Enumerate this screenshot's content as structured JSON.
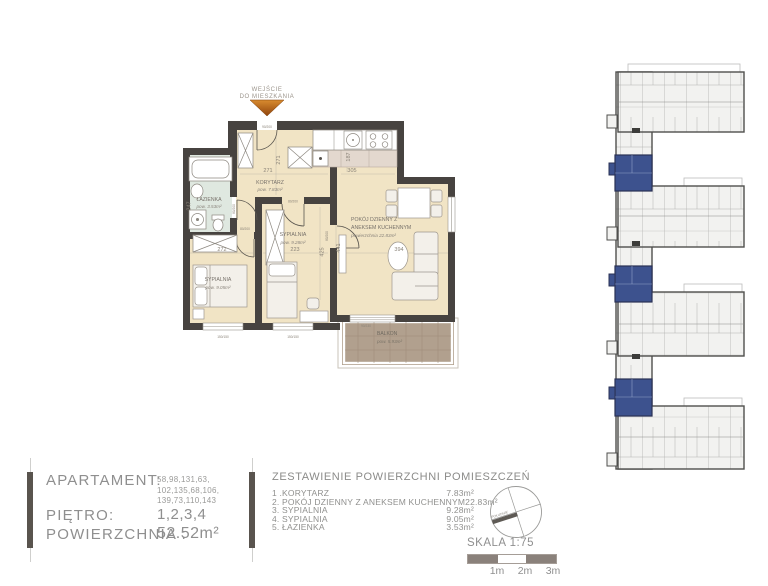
{
  "entrance": {
    "line1": "WEJŚCIE",
    "line2": "DO MIESZKANIA",
    "size_label": "90/200"
  },
  "rooms": {
    "lazienka": {
      "name": "ŁAZIENKA",
      "area": "pow. 3.53m²"
    },
    "korytarz": {
      "name": "KORYTARZ",
      "area": "pow. 7.83m²"
    },
    "sypialnia_3": {
      "name": "SYPIALNIA",
      "area": "pow. 9.28m²"
    },
    "sypialnia_4": {
      "name": "SYPIALNIA",
      "area": "pow. 9.05m²"
    },
    "pokoj": {
      "name_line1": "POKÓJ DZIENNY Z",
      "name_line2": "ANEKSEM KUCHENNYM",
      "area": "powierzchnia 22.83m²"
    },
    "balkon": {
      "name": "BALKON",
      "area": "pow. 5.93m²"
    }
  },
  "dimensions": {
    "korytarz_w": "271",
    "korytarz_h": "271",
    "kuchnia_w": "305",
    "kuchnia_d": "187",
    "lazienka_h": "247",
    "sypialnia4_w": "272",
    "sypialnia3_w": "223",
    "pokoj_w": "394",
    "pokoj_h": "441",
    "sypialnia3_h": "425"
  },
  "openings": {
    "door_bath": "80/200",
    "door_bed4": "80/200",
    "door_bed3": "80/200",
    "door_living": "80/200",
    "window_bed4": "150/150",
    "window_bed3": "150/150",
    "balcony_door": "90/230"
  },
  "info": {
    "apartament_label": "APARTAMENT:",
    "numbers_line1": "58,98,131,63,",
    "numbers_line2": "102,135,68,106,",
    "numbers_line3": "139,73,110,143",
    "pietro_label": "PIĘTRO:",
    "pietro_value": "1,2,3,4",
    "powierzchnia_label": "POWIERZCHNIA :",
    "powierzchnia_value": "52.52m²"
  },
  "room_list": {
    "title": "ZESTAWIENIE POWIERZCHNI POMIESZCZEŃ",
    "items": [
      {
        "label": "1 .KORYTARZ",
        "value": "7.83m²"
      },
      {
        "label": "2. POKÓJ DZIENNY Z ANEKSEM KUCHENNYM",
        "value": "22.83m²"
      },
      {
        "label": "3. SYPIALNIA",
        "value": "9.28m²"
      },
      {
        "label": "4. SYPIALNIA",
        "value": "9.05m²"
      },
      {
        "label": "5. ŁAZIENKA",
        "value": "3.53m²"
      }
    ]
  },
  "scale": {
    "label": "SKALA 1:75",
    "tick1": "1m",
    "tick2": "2m",
    "tick3": "3m",
    "compass_label": "POŁUDNIE"
  },
  "colors": {
    "wall": "#474340",
    "floor": "#f1e4c5",
    "bathroom": "#dfe8e0",
    "balcony": "#b1a08e",
    "highlight_blue": "#3d528e",
    "arrow_orange": "#bc6414",
    "text_gray": "#8f8f8f"
  }
}
